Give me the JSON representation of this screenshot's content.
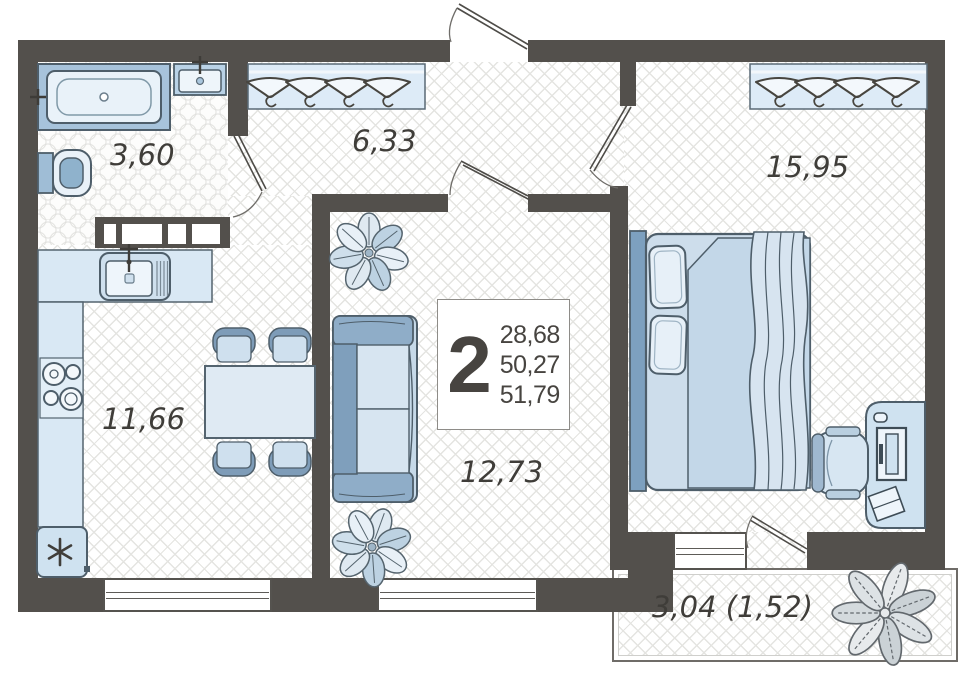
{
  "floorplan": {
    "unit_label": "2",
    "area_values": [
      "28,68",
      "50,27",
      "51,79"
    ],
    "rooms": {
      "bathroom": {
        "area": "3,60"
      },
      "hallway": {
        "area": "6,33"
      },
      "bedroom": {
        "area": "15,95"
      },
      "kitchen": {
        "area": "11,66"
      },
      "living_room": {
        "area": "12,73"
      },
      "balcony": {
        "area": "3,04 (1,52)"
      }
    },
    "colors": {
      "wall": "#53504c",
      "furniture_light": "#d7e7f3",
      "furniture_accent": "#7d9fbd",
      "outline": "#4e5e6a"
    }
  }
}
